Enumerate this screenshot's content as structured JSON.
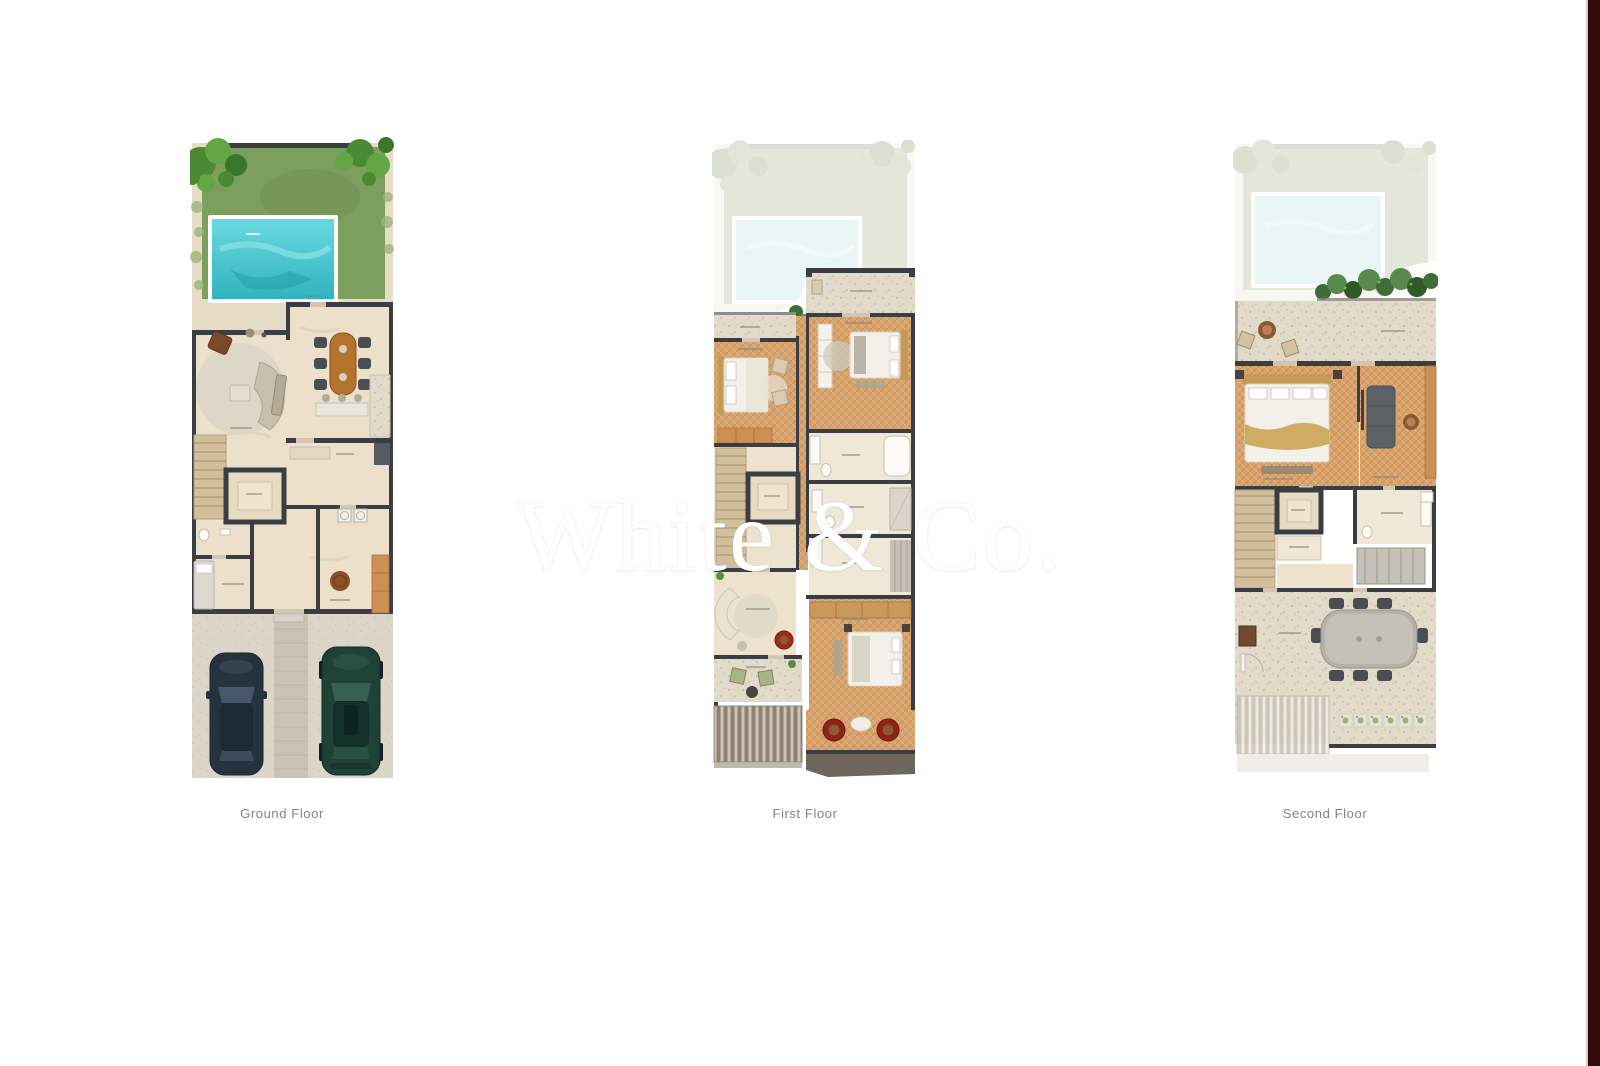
{
  "watermark": {
    "text": "White & Co."
  },
  "floors": [
    {
      "id": "ground",
      "label": "Ground Floor"
    },
    {
      "id": "first",
      "label": "First Floor"
    },
    {
      "id": "second",
      "label": "Second Floor"
    }
  ],
  "palette": {
    "page_bg": "#ffffff",
    "accent_strip": "#310a0d",
    "accent_strip_edge": "#d8c9c9",
    "label_text": "#838487",
    "watermark_color": "#ffffff",
    "wall": "#3a3e42",
    "lawn": "#7d9f5e",
    "tree_dark": "#3c762c",
    "tree_mid": "#4a8a34",
    "tree_light": "#63a646",
    "pool_water": "#45c4cd",
    "floor_beige": "#ece0ca",
    "patio_beige": "#e7dcc5",
    "terracotta": "#d7a26c",
    "wood": "#b5742e",
    "wardrobe_orange": "#cc9055",
    "chair_dark": "#4a4e52",
    "accent_red": "#9e2a1a",
    "balcony_green": "#a7b487",
    "driveway": "#d8d2c8",
    "car_navy": "#27323f",
    "car_green": "#1f4237",
    "ghost_opacity": "0.33"
  }
}
